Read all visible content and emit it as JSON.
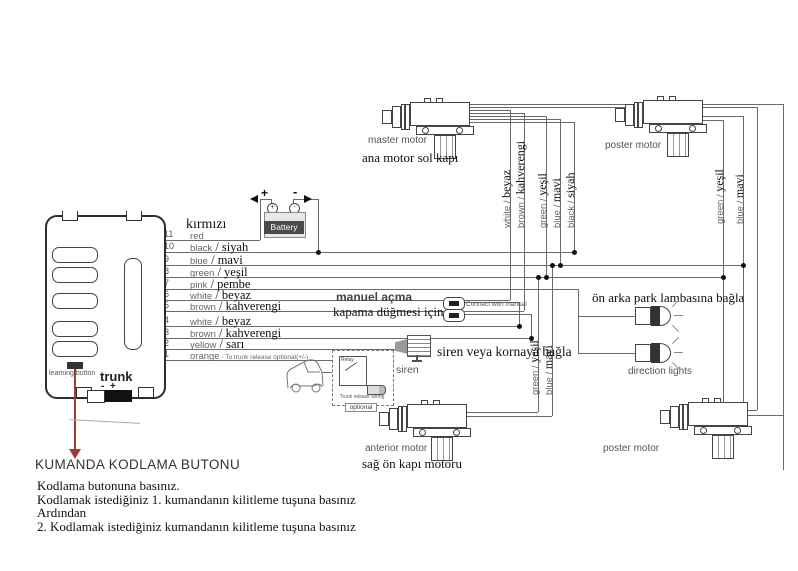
{
  "control_unit": {
    "learning_button": "learning button",
    "trunk": "trunk",
    "trunk_polarity": "-  +"
  },
  "battery": {
    "label": "Battery",
    "plus": "+",
    "minus": "-"
  },
  "wire_header_tr": "kırmızı",
  "wires": [
    {
      "no": "11",
      "en": "red",
      "tr": ""
    },
    {
      "no": "10",
      "en": "black",
      "tr": "siyah"
    },
    {
      "no": "9",
      "en": "blue",
      "tr": "mavi"
    },
    {
      "no": "8",
      "en": "green",
      "tr": "yeşil"
    },
    {
      "no": "7",
      "en": "pink",
      "tr": "pembe"
    },
    {
      "no": "6",
      "en": "white",
      "tr": "beyaz"
    },
    {
      "no": "5",
      "en": "brown",
      "tr": "kahverengi"
    },
    {
      "no": "4",
      "en": "white",
      "tr": "beyaz"
    },
    {
      "no": "3",
      "en": "brown",
      "tr": "kahverengi"
    },
    {
      "no": "2",
      "en": "yellow",
      "tr": "sarı"
    },
    {
      "no": "1",
      "en": "orange",
      "tr": "",
      "note": "- To trunk release optional(+/-)"
    }
  ],
  "motors": {
    "master": {
      "en": "master motor",
      "tr": "ana motor sol kapı"
    },
    "poster_top": {
      "en": "poster motor"
    },
    "anterior": {
      "en": "anterior motor",
      "tr": "sağ ön kapı motoru"
    },
    "poster_bottom": {
      "en": "poster motor"
    }
  },
  "wire_labels": {
    "master": [
      "white / beyaz",
      "brown / kahverengi",
      "green / yeşil",
      "blue / mavi",
      "black/ siyah"
    ],
    "anterior": [
      "green / yeşil",
      "blue / mavi"
    ],
    "poster_top": [
      "green / yeşil",
      "blue / mavi"
    ]
  },
  "annotations": {
    "manual_line1": "manuel açma",
    "manual_line2": "kapama düğmesi için",
    "connect_with_manual": "Connect with manual",
    "park_lamps": "ön arka park lambasına bağla",
    "direction_lights": "direction lights",
    "siren_connect": "siren veya kornaya bağla",
    "siren": "siren",
    "relay": "Relay",
    "trunk_release_wiring": "Trunk release wiring",
    "optional": "optional"
  },
  "instructions": {
    "heading": "KUMANDA KODLAMA BUTONU",
    "lines": [
      "Kodlama butonuna basınız.",
      "Kodlamak istediğiniz 1. kumandanın kilitleme tuşuna basınız",
      "Ardından",
      "2. Kodlamak istediğiniz kumandanın kilitleme tuşuna basınız"
    ]
  },
  "colors": {
    "wire": "#6a6a6a",
    "red_wire": "#9c3c32",
    "dark": "#333333"
  }
}
